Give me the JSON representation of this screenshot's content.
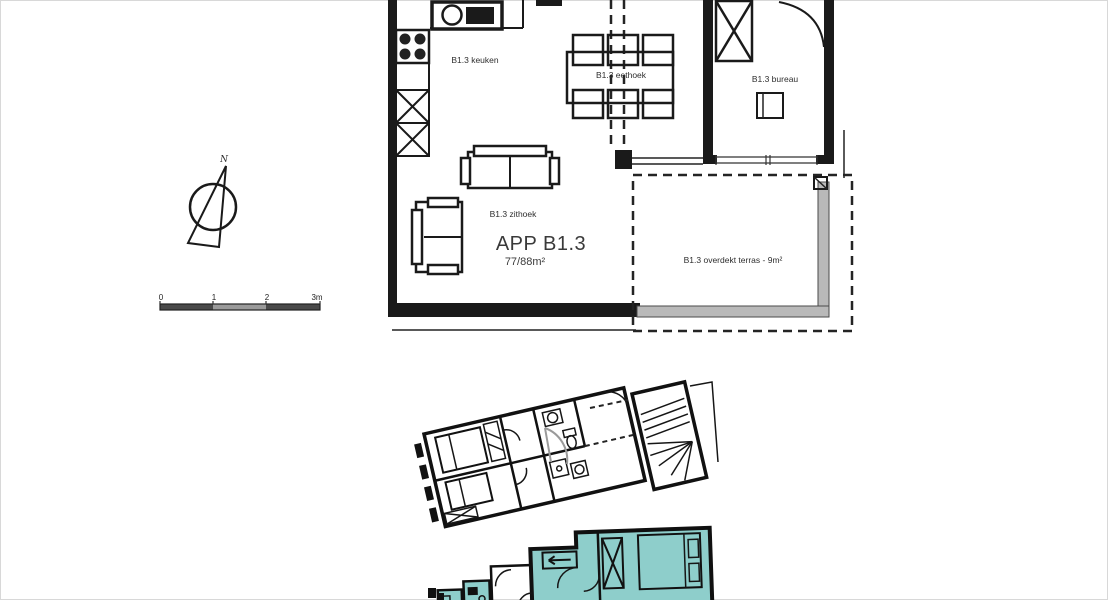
{
  "colors": {
    "line": "#1a1a1a",
    "gray_rail": "#b9b9b9",
    "highlight": "#8ececb"
  },
  "main_plan": {
    "apartment_label": "APP B1.3",
    "apartment_area": "77/88m²",
    "rooms": {
      "kitchen": "B1.3 keuken",
      "dining": "B1.3 eethoek",
      "office": "B1.3 bureau",
      "sitting": "B1.3 zithoek",
      "terrace": "B1.3 overdekt terras - 9m²"
    }
  },
  "compass": {
    "north_label": "N"
  },
  "scale_bar": {
    "labels": [
      "0",
      "1",
      "2",
      "3m"
    ]
  },
  "site_plan": {
    "highlight_color": "#8ececb"
  }
}
